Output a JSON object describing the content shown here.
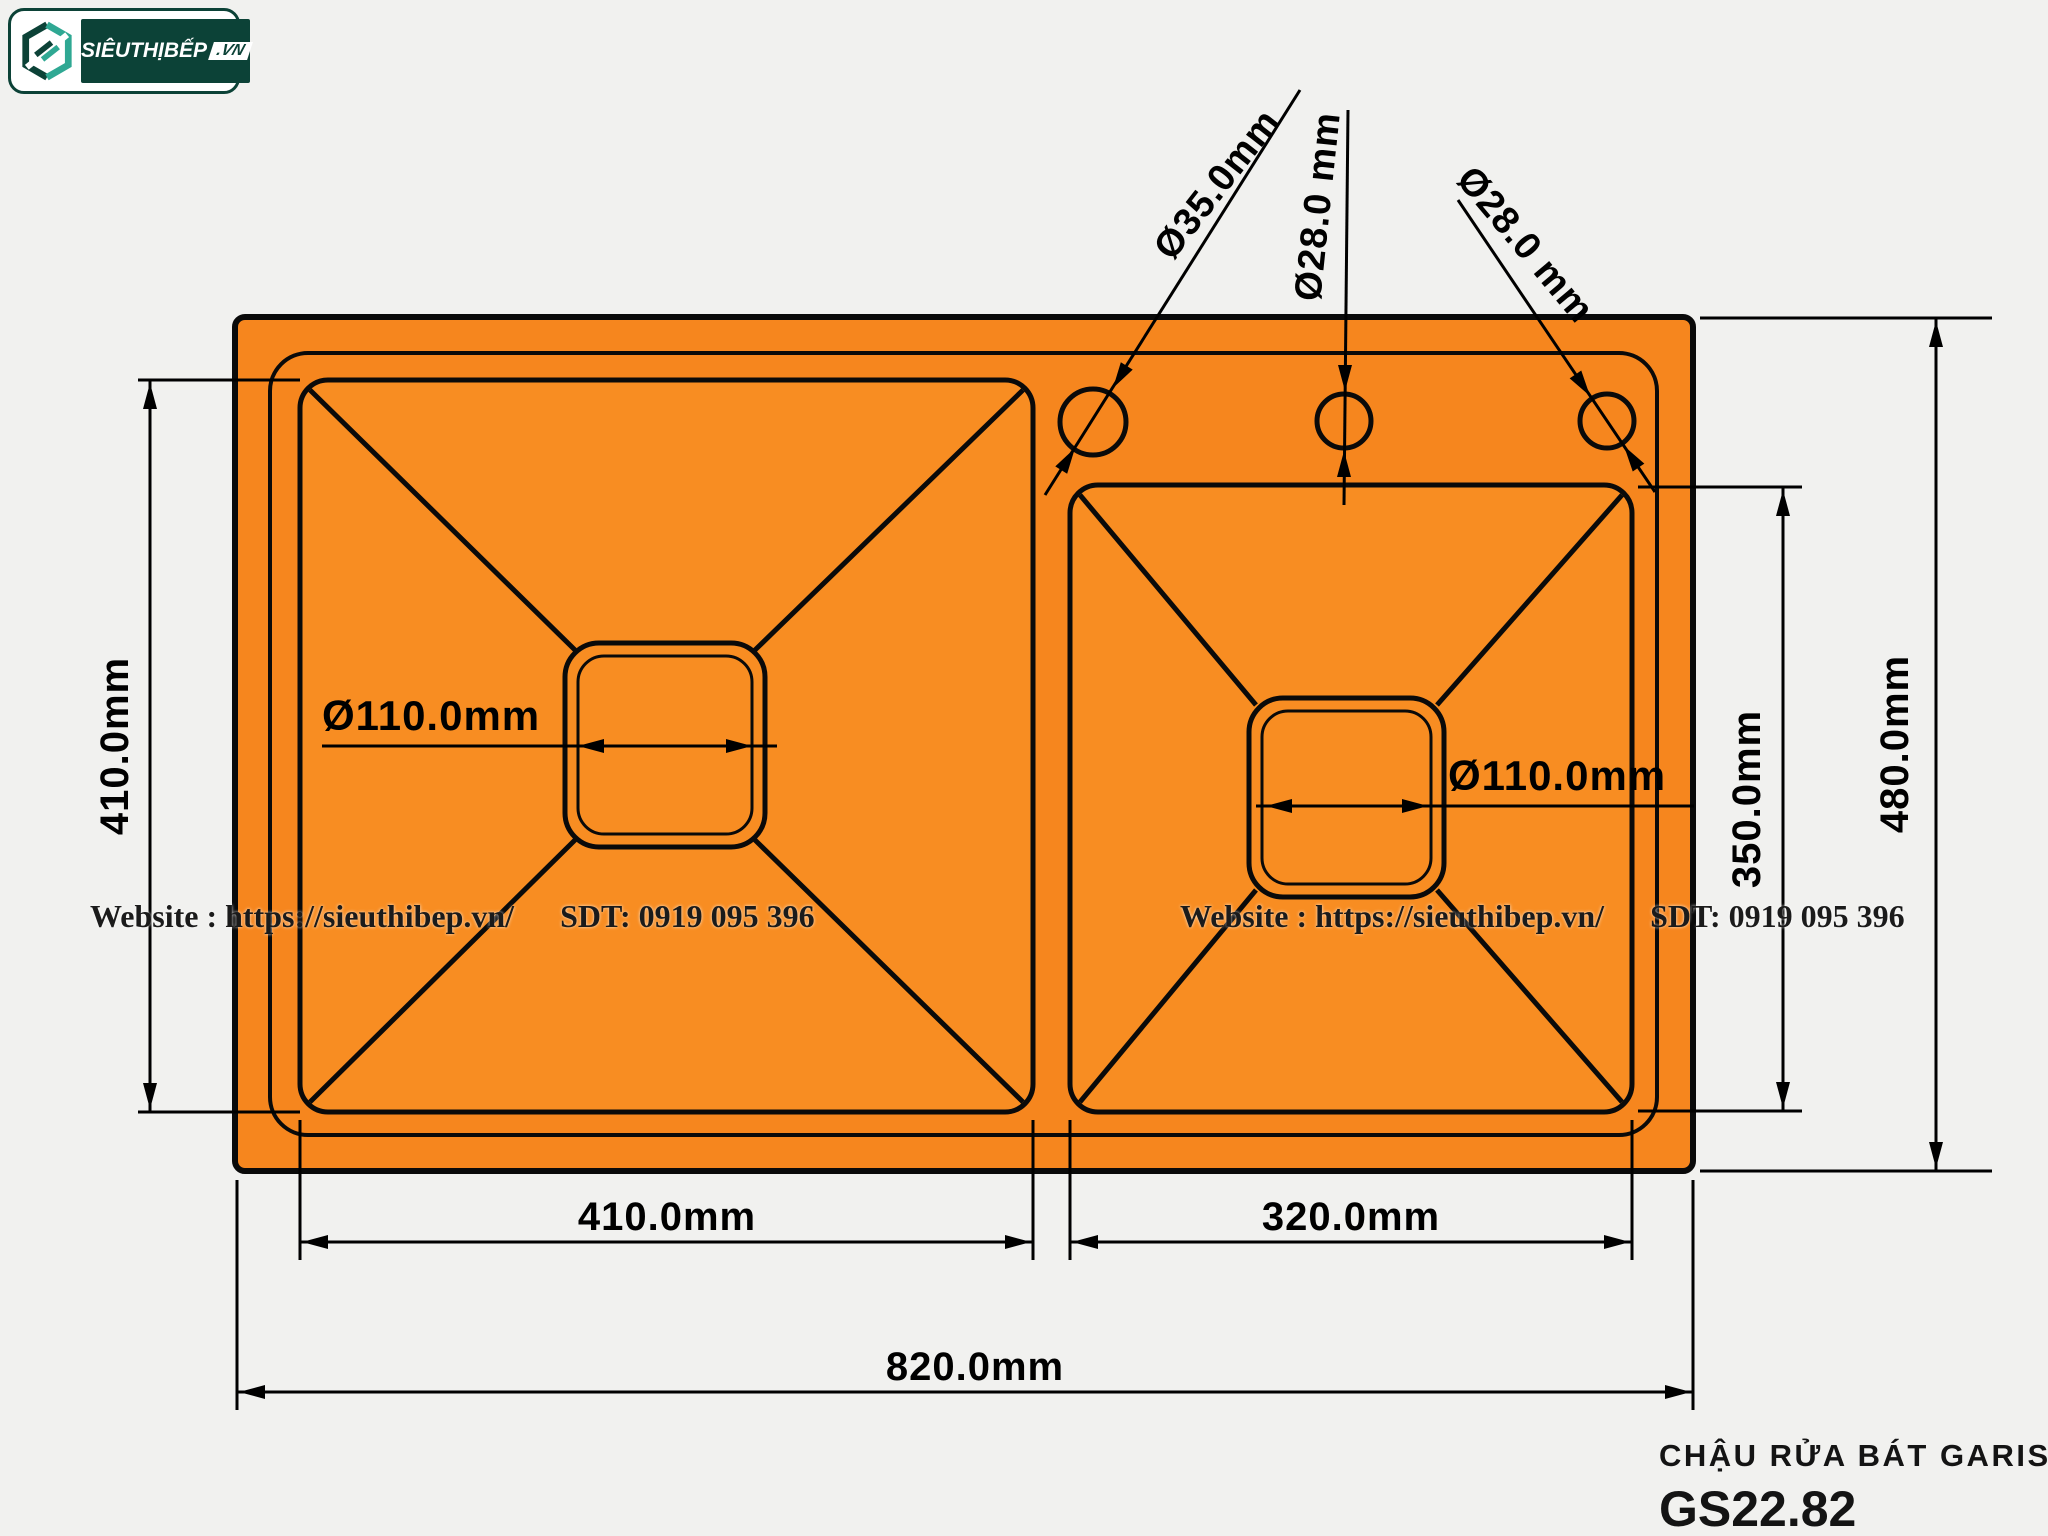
{
  "colors": {
    "bg": "#f1f1ef",
    "sink-orange": "#f6861e",
    "bowl-orange": "#f88d22",
    "brand-green": "#0c4237",
    "ink": "#1b1b1b"
  },
  "logo": {
    "brand": "SIÊUTHỊBẾP",
    "tld": ".VN",
    "icon": "hexagon-s-logo"
  },
  "watermark": {
    "website": "Website : https://sieuthibep.vn/",
    "phone": "SDT: 0919 095 396"
  },
  "product": {
    "title": "CHẬU RỬA BÁT GARIS",
    "model": "GS22.82"
  },
  "dimensions": {
    "overall_width": "820.0mm",
    "overall_depth": "480.0mm",
    "left_bowl_width": "410.0mm",
    "left_bowl_depth": "410.0mm",
    "right_bowl_width": "320.0mm",
    "right_bowl_depth": "350.0mm",
    "left_drain": "Ø110.0mm",
    "right_drain": "Ø110.0mm",
    "faucet_hole_1": "Ø35.0mm",
    "faucet_hole_2": "Ø28.0 mm",
    "faucet_hole_3": "Ø28.0 mm"
  }
}
